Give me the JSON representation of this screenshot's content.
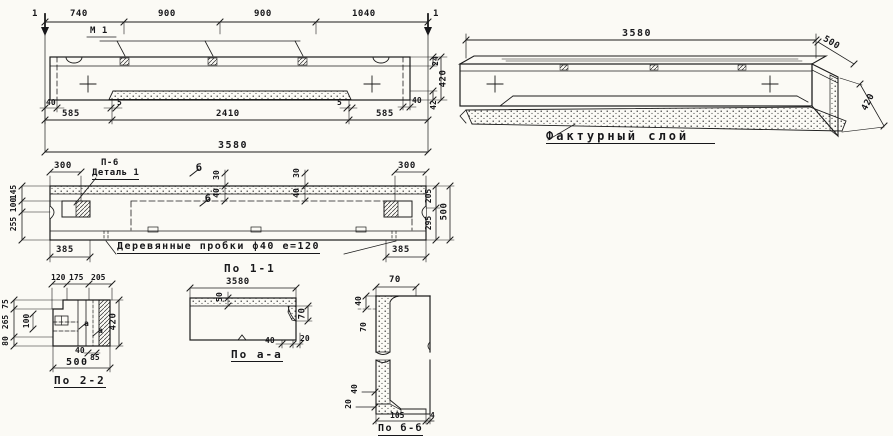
{
  "colors": {
    "ink": "#17171a",
    "paper": "#fbfaf5"
  },
  "elevation": {
    "marker_left": "1",
    "marker_right": "1",
    "mark_label": "М 1",
    "dims_top": [
      "740",
      "900",
      "900",
      "1040"
    ],
    "dim_ledge_left": "40",
    "dim_recess_left": "5",
    "dim_recess_right": "5",
    "dim_ledge_right": "40",
    "dim_side_top": "24",
    "dim_side_height": "420",
    "dim_side_bottom": "42",
    "dims_mid": [
      "585",
      "2410",
      "585"
    ],
    "dim_total": "3580"
  },
  "isometric": {
    "dim_length": "3580",
    "dim_width": "500",
    "dim_height": "420",
    "facture_label": "Фактурный слой"
  },
  "plan": {
    "dim_offset_left": "300",
    "dim_offset_right": "300",
    "label_p6": "П-6",
    "label_detail": "Деталь 1",
    "marker_b_top": "б",
    "marker_b_bottom": "б",
    "recess_dims_1": [
      "30",
      "40"
    ],
    "recess_dims_2": [
      "30",
      "40"
    ],
    "dims_left": [
      "145",
      "100",
      "255"
    ],
    "dims_right": [
      "205",
      "295"
    ],
    "dim_width_total": "500",
    "dim_end_left": "385",
    "dim_end_right": "385",
    "plug_label": "Деревянные пробки ф40 е=120"
  },
  "section_2_2": {
    "title": "По 2-2",
    "dims_top": [
      "120",
      "175",
      "205"
    ],
    "dims_left": [
      "75",
      "265",
      "80"
    ],
    "dim_inner": "100",
    "marker_a_1": "а",
    "marker_a_2": "а",
    "dim_height": "420",
    "dim_small_1": "40",
    "dim_small_2": "85",
    "dim_width": "500"
  },
  "section_1_1": {
    "title": "По 1-1",
    "dim_length": "3580",
    "dim_layer": "50",
    "dim_step": "70",
    "dim_b1": "40",
    "dim_b2": "20",
    "subtitle": "По а-а"
  },
  "section_b_b": {
    "title": "По б-б",
    "dim_top": "70",
    "dim_upper": "40",
    "dim_wall": "70",
    "dim_lower1": "40",
    "dim_lower2": "20",
    "dim_b1": "105",
    "dim_b2": "4"
  }
}
